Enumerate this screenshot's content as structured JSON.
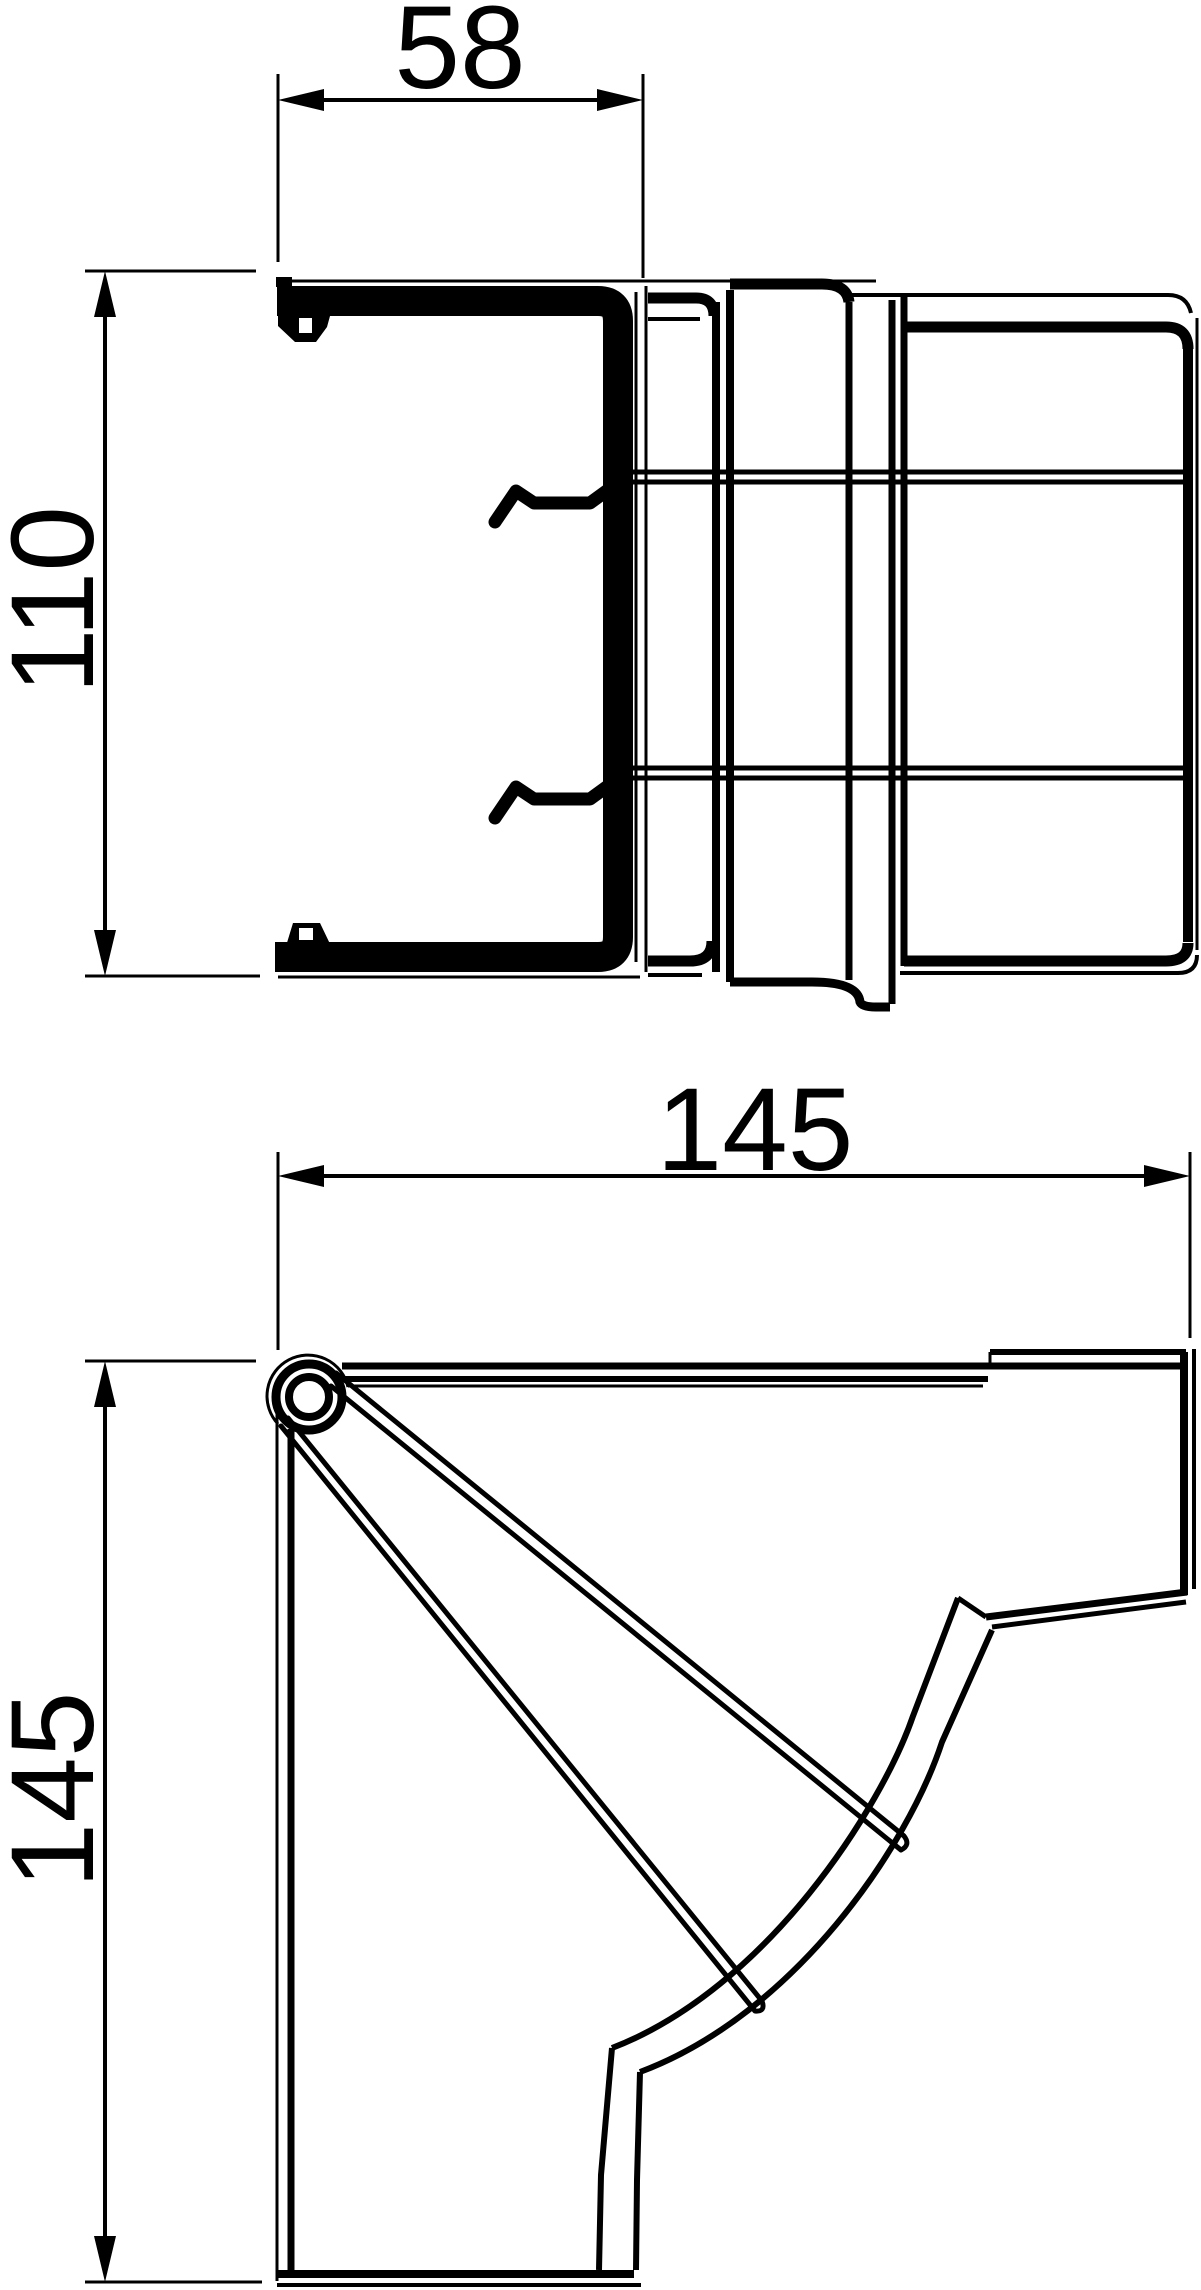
{
  "page": {
    "background": "#ffffff",
    "line_color": "#000000"
  },
  "drawing": {
    "type": "technical-drawing",
    "views": [
      {
        "id": "top-view",
        "dimensions": [
          {
            "label": "58",
            "orientation": "horizontal"
          },
          {
            "label": "110",
            "orientation": "vertical"
          }
        ]
      },
      {
        "id": "front-view",
        "dimensions": [
          {
            "label": "145",
            "orientation": "horizontal"
          },
          {
            "label": "145",
            "orientation": "vertical"
          }
        ]
      }
    ]
  }
}
